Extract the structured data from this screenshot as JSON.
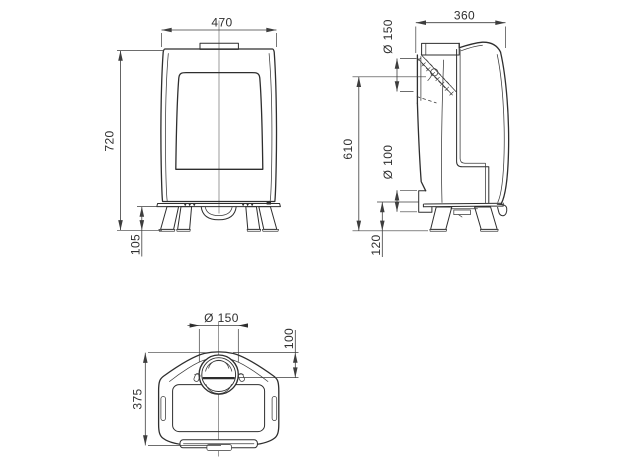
{
  "sheet": {
    "background": "#ffffff",
    "line_color": "#2e2e2e",
    "dimension_color": "#3d3d3d"
  },
  "views": {
    "front": {
      "width_mm": "470",
      "total_height_mm": "720",
      "leg_clearance_mm": "105"
    },
    "side": {
      "depth_mm": "360",
      "flue_collar_diameter": "Ø 150",
      "flue_center_height_mm": "610",
      "rear_inlet_diameter": "Ø 100",
      "rear_inlet_center_height_mm": "120"
    },
    "top": {
      "flue_collar_diameter": "Ø 150",
      "flue_center_to_back_mm": "100",
      "depth_mm": "375"
    }
  }
}
